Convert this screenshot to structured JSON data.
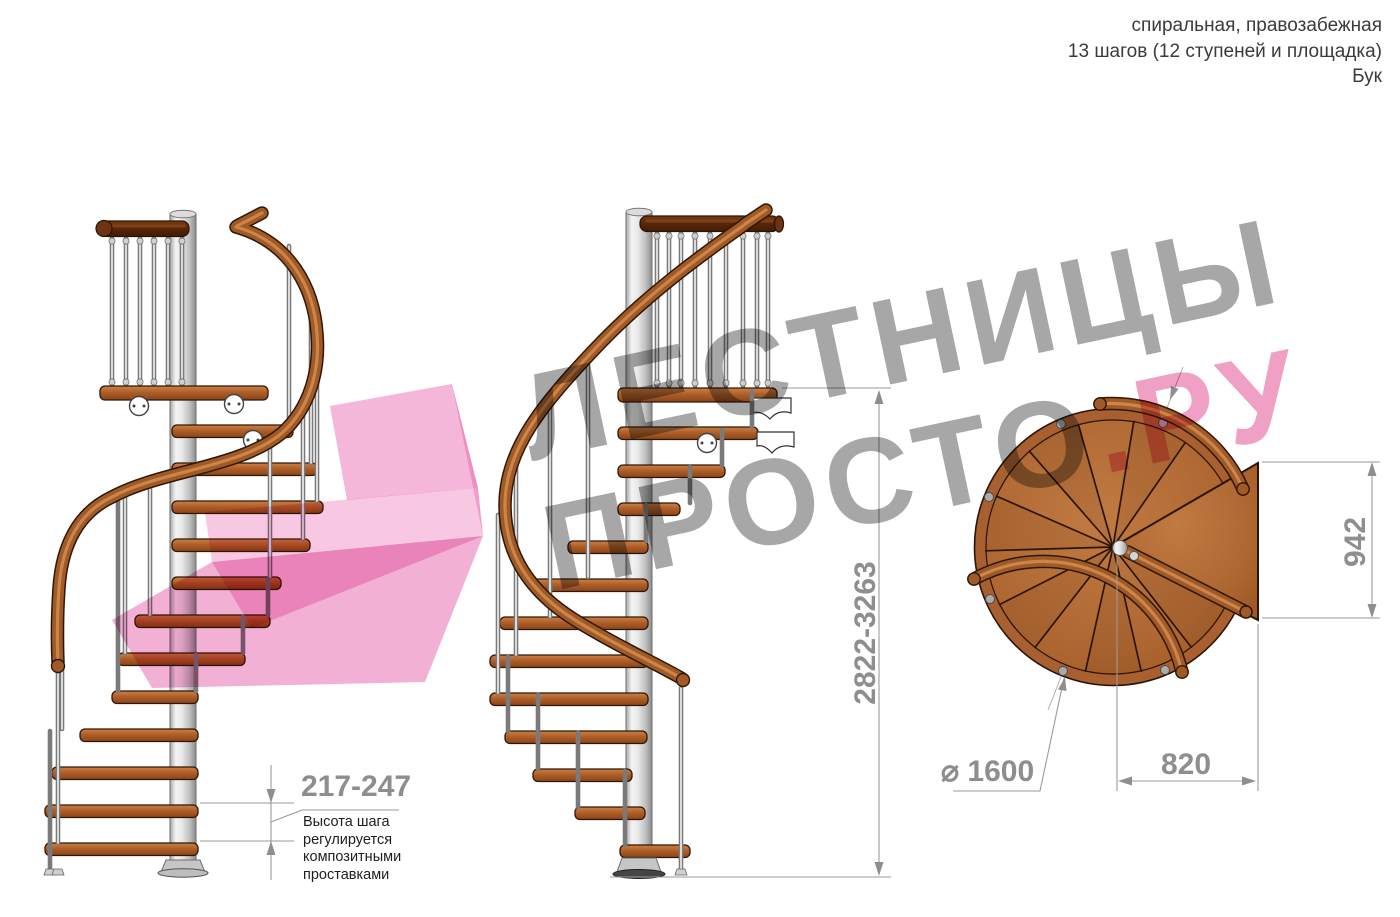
{
  "header": {
    "line1": "спиральная, правозабежная",
    "line2": "13 шагов (12 ступеней и площадка)",
    "line3": "Бук"
  },
  "watermark": {
    "line1": "ЛЕСТНИЦЫ",
    "line2_gray": "ПРОСТО",
    "line2_accent": ".РУ"
  },
  "dimensions": {
    "total_height": "2822-3263",
    "step_height": "217-247",
    "step_height_note": "Высота шага\nрегулируется\nкомпозитными\nпроставками",
    "plan_depth": "942",
    "plan_width": "820",
    "diameter": "⌀ 1600"
  },
  "colors": {
    "accent_pink": "#f0a0c4",
    "watermark_gray": "#a7a7a7",
    "wood": "#a85c28",
    "dimension_gray": "#8e8e8e"
  }
}
